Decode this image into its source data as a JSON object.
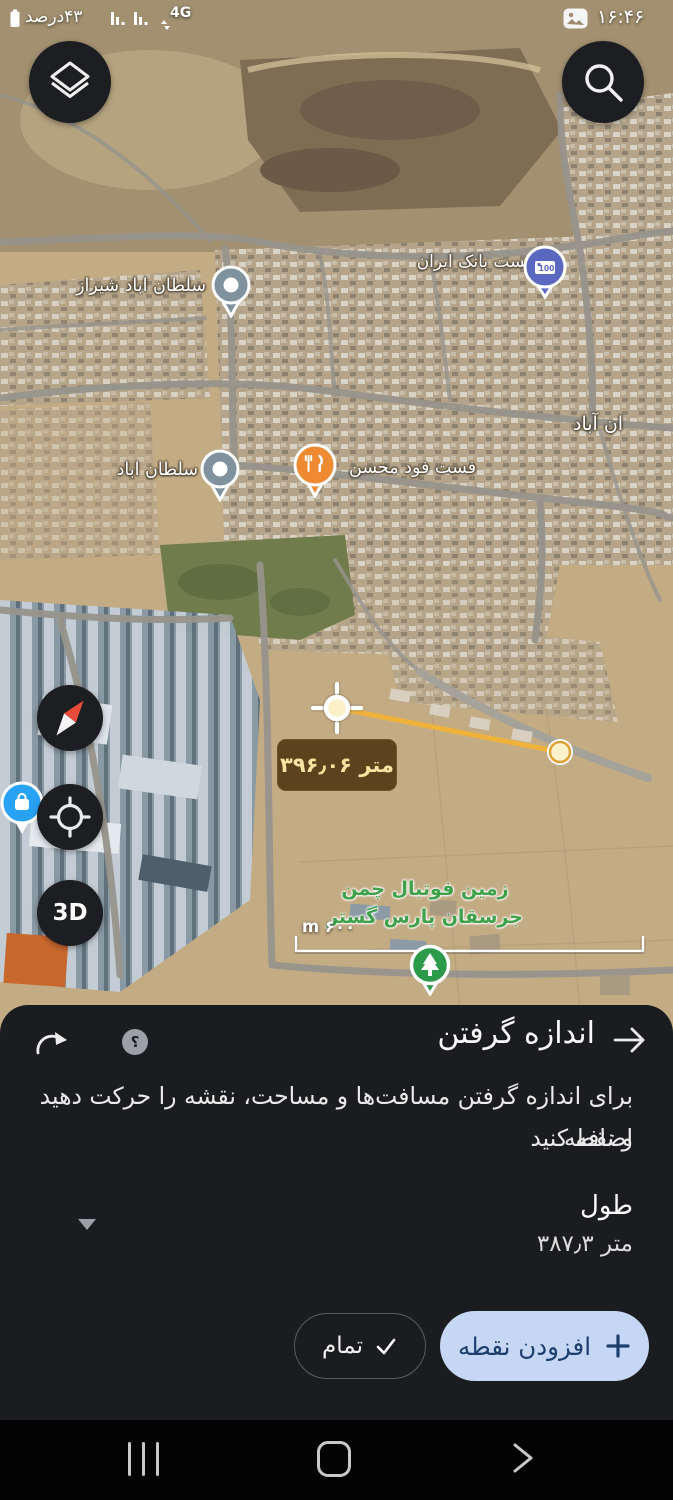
{
  "colors": {
    "sheet_bg": "#1b1c1f",
    "add_button_bg": "#c6d7f6",
    "add_button_text": "#1d3f6f",
    "measure_line": "#efb23c",
    "measure_chip_bg": "#5b431d",
    "measure_chip_text": "#f9e3a0",
    "poi_green": "#3fa14b"
  },
  "status_bar": {
    "battery_label": "۴۳درصد",
    "network_label": "4G",
    "time": "۱۶:۴۶"
  },
  "map": {
    "labels": {
      "sultanabad_shiraz": "سلطان اباد شیراز",
      "post_bank_iran": "پست بانک ایران",
      "sultanabad": "سلطان اباد",
      "fastfood_mohsen": "فست فود محسن",
      "an_abad": "ان آباد",
      "football_line1": "زمین فوتبال چمن",
      "football_line2": "جرسقان پارس گستر"
    },
    "bank_pin_text": "100",
    "measurement": {
      "distance_label": "۳۹۶٫۰۶ متر"
    },
    "scale_label": "m ۶۰۰",
    "three_d_label": "3D"
  },
  "sheet": {
    "title": "اندازه گرفتن",
    "help_glyph": "؟",
    "description_line1": "برای اندازه گرفتن مسافت‌ها و مساحت، نقشه را حرکت دهید و نقطه",
    "description_line2": "اضافه کنید",
    "length_label": "طول",
    "length_value": "۳۸۷٫۳ متر",
    "add_point_label": "افزودن نقطه",
    "done_label": "تمام"
  }
}
